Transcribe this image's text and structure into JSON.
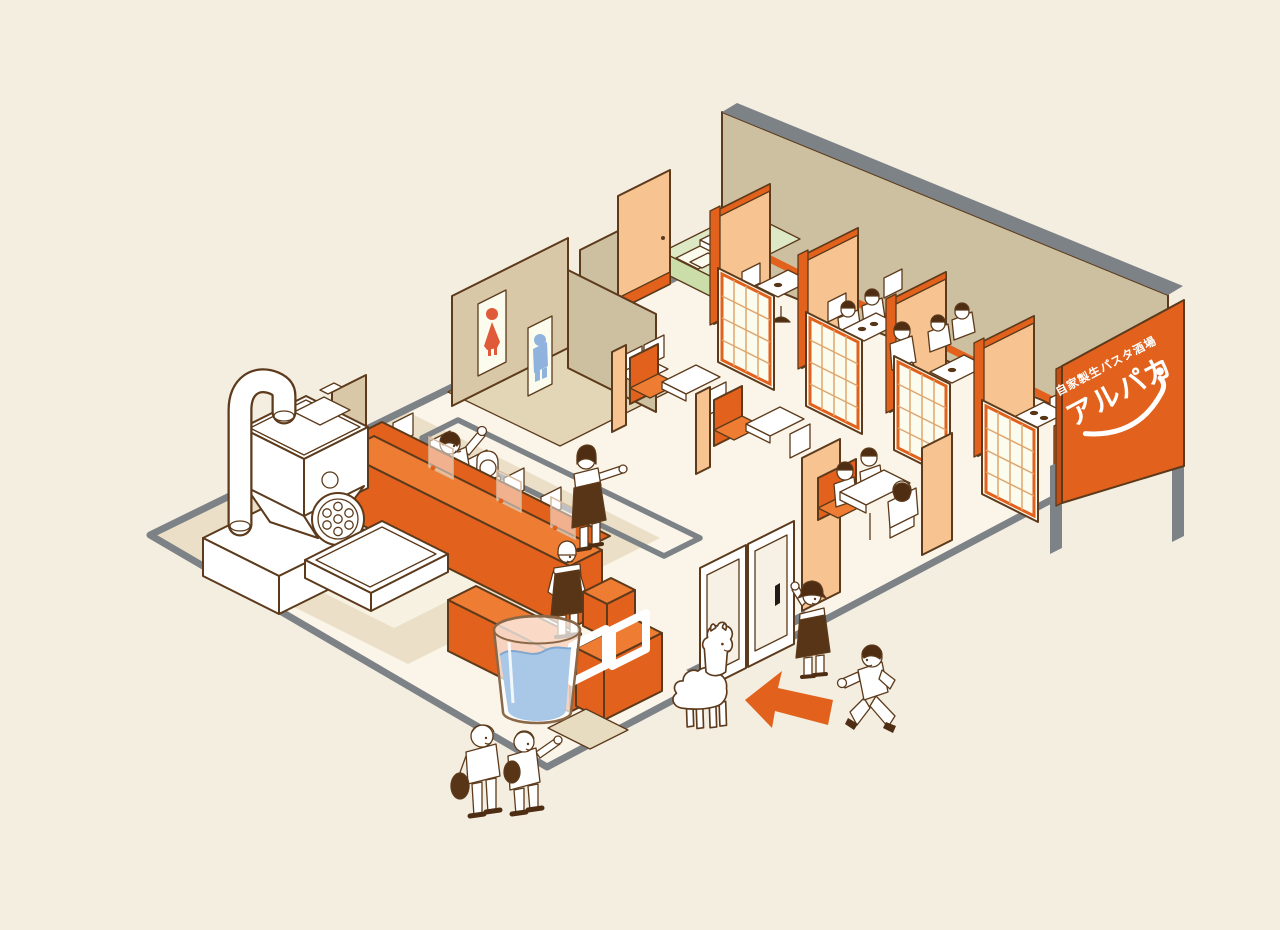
{
  "scene": {
    "description": "Isometric cutaway illustration of a Japanese homemade fresh pasta bar restaurant interior with an alpaca mascot at the entrance",
    "visible_text_location": "orange signboard at right"
  },
  "signboard": {
    "tagline": "自家製生パスタ酒場",
    "name": "アルパカ"
  },
  "icons": [
    "restroom-female-icon",
    "restroom-male-icon",
    "entrance-arrow-icon",
    "alpaca-mascot",
    "sign-smile-icon"
  ],
  "inventory": {
    "private_booths": 4,
    "shoji_screens": 4,
    "counter_chairs": 5,
    "counter_partitions": 3,
    "window_frames": 2,
    "staff_figures": 3,
    "customer_figures": 13,
    "restroom_signs": 2
  },
  "colors": {
    "background": "#f4eee1",
    "floor_main": "#faf5e8",
    "floor_inset": "#f7f1e1",
    "floor_beige": "#ebe0c7",
    "floor_restroom": "#e3d6b6",
    "mat_tan": "#e8dcc0",
    "wall_khaki": "#ccc0a0",
    "wall_tan": "#d8c8a8",
    "wall_gray": "#7d8287",
    "outline": "#5c3a1b",
    "orange": "#e2611c",
    "orange_light": "#ee7c33",
    "peach": "#f6c391",
    "shoji_grid": "#dfa76f",
    "tatami_green": "#dde9c5",
    "tatami_edge": "#cbdda8",
    "mat_white": "#fbfbee",
    "water_blue": "#a9c8e8",
    "water_line": "#7fa7cf",
    "glass_stroke": "#8a6848",
    "door_glass": "#f6f1e4",
    "handle_black": "#1f1b16",
    "restroom_female_red": "#e05a3a",
    "restroom_male_blue": "#8fb3dd",
    "hair_brown": "#4e2d13",
    "apron_brown": "#573516",
    "white": "#ffffff"
  }
}
